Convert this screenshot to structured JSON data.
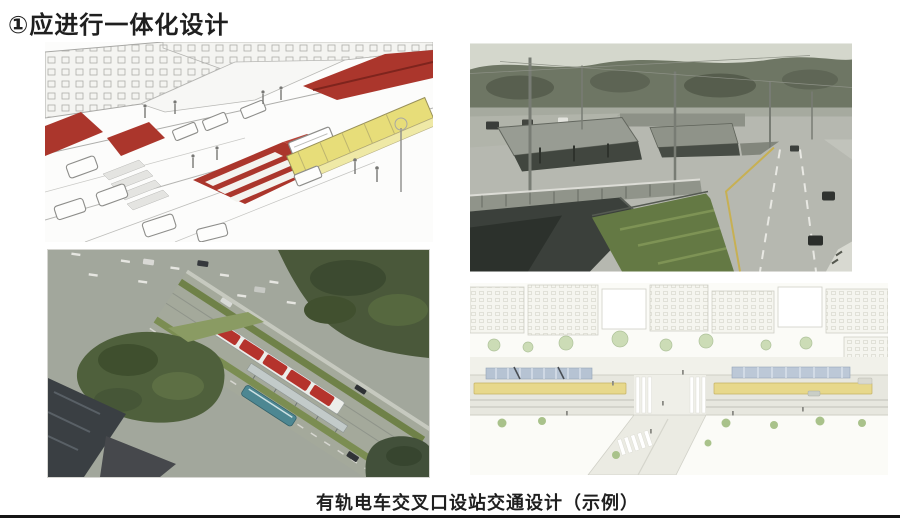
{
  "page": {
    "title": "①应进行一体化设计",
    "caption": "有轨电车交叉口设站交通设计（示例）"
  },
  "colors": {
    "transit_lane_red": "#ab362c",
    "station_canopy_yellow": "#e7dd79",
    "tram_roof_red": "#b5332c",
    "bus_teal": "#4d8792",
    "plan_platform_yellow": "#e7d88b",
    "plan_canopy_blue": "#b6c3d3",
    "title_text": "#1f1f1f",
    "caption_text": "#1f1f1f",
    "bottom_rule": "#161616"
  },
  "figures": {
    "top_left": {
      "id": "integrated-intersection-sketch"
    },
    "top_right": {
      "id": "brt-station-photo"
    },
    "bottom_left": {
      "id": "tram-intersection-aerial-render"
    },
    "bottom_right": {
      "id": "station-siting-plan-sketch"
    }
  }
}
